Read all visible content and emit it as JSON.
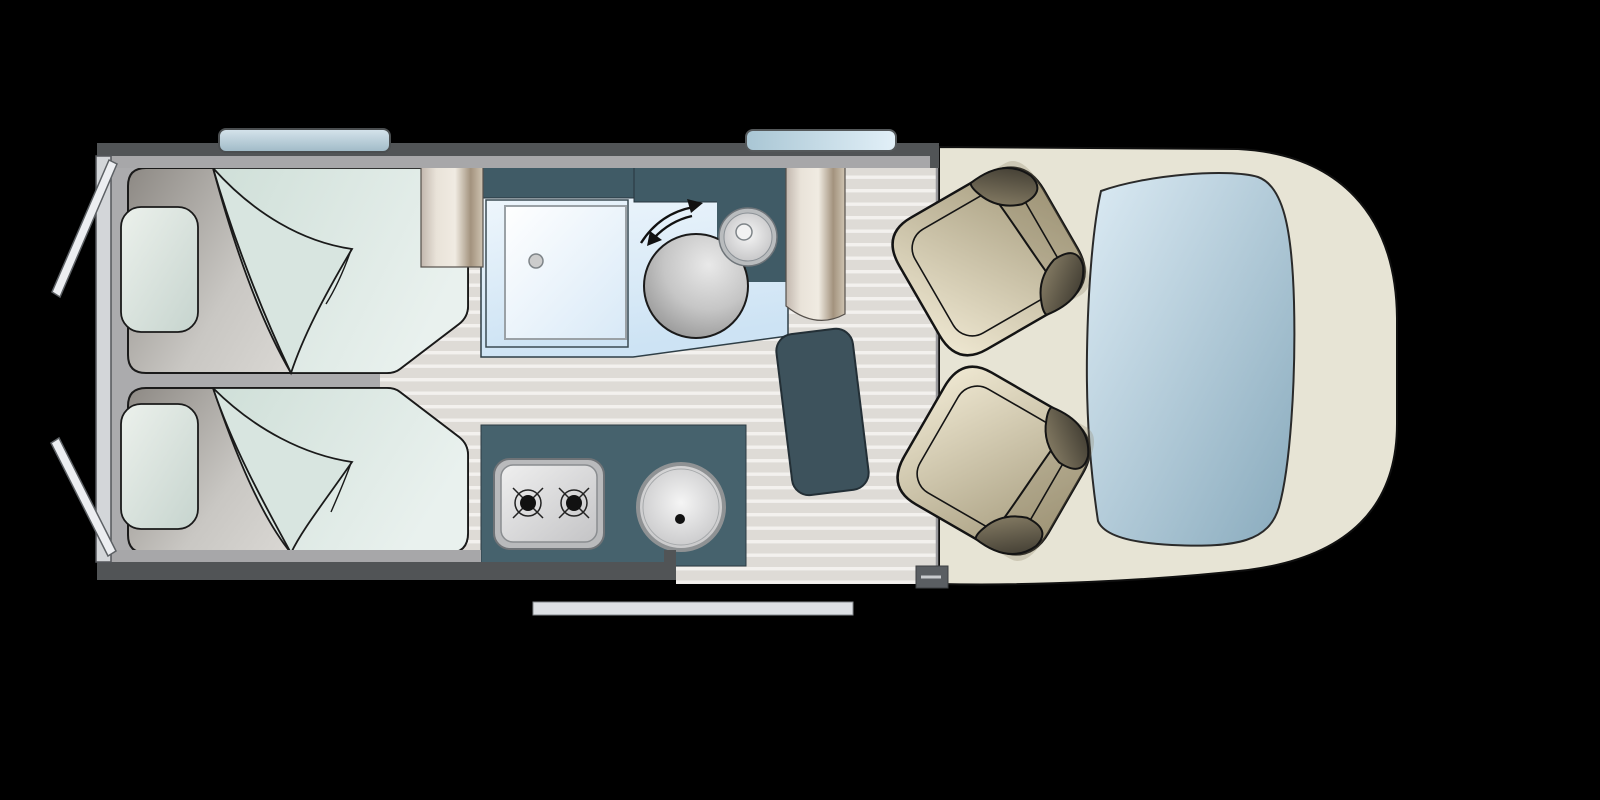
{
  "scene": {
    "description": "campervan-floorplan-top-view",
    "background": "#000000"
  },
  "palette": {
    "wall_dark": "#515456",
    "wall_light": "#a7a7a9",
    "rear_frame": "#d3d6d9",
    "door_panel": "#eceef1",
    "bedroom_base": "#ababad",
    "floor_base": "#dedbd6",
    "floor_stripe": "#f3f1ee",
    "teal_cabinet": "#405b66",
    "teal_counter": "#46626d",
    "table": "#3d525c",
    "cab_floor": "#e7e4d5",
    "step": "#5a5e62",
    "slide_door": "#dde0e4",
    "stove_frame": "#b9babc",
    "sink_ring": "#b9bcbe",
    "toilet_stroke": "#1a1a1a"
  },
  "features": {
    "rear_door_top": "rear-door-open-top",
    "rear_door_bottom": "rear-door-open-bottom",
    "roof_window_rear": "roof-window",
    "roof_window_mid": "roof-window",
    "bed_top": "single-bed",
    "bed_bottom": "single-bed",
    "pillow_top": "pillow",
    "pillow_bottom": "pillow",
    "blanket_top": "folded-blanket",
    "blanket_bottom": "folded-blanket",
    "wardrobe_left": "wardrobe-column",
    "wardrobe_right": "wardrobe-column",
    "overhead_cabinet_left": "overhead-cabinet",
    "overhead_cabinet_right": "overhead-cabinet",
    "shower": "shower-tray",
    "toilet": "swivel-toilet",
    "swivel_arrows": "rotation-arrows",
    "washbasin": "washbasin",
    "kitchen_counter": "kitchen-unit",
    "hob": "two-burner-hob",
    "kitchen_sink": "round-sink",
    "table": "table",
    "entry_step": "entry-step",
    "sliding_door": "sliding-door-open",
    "cab": "driver-cab-floor",
    "windshield": "windscreen",
    "seat_top": "swivel-captain-seat",
    "seat_bottom": "swivel-captain-seat"
  }
}
